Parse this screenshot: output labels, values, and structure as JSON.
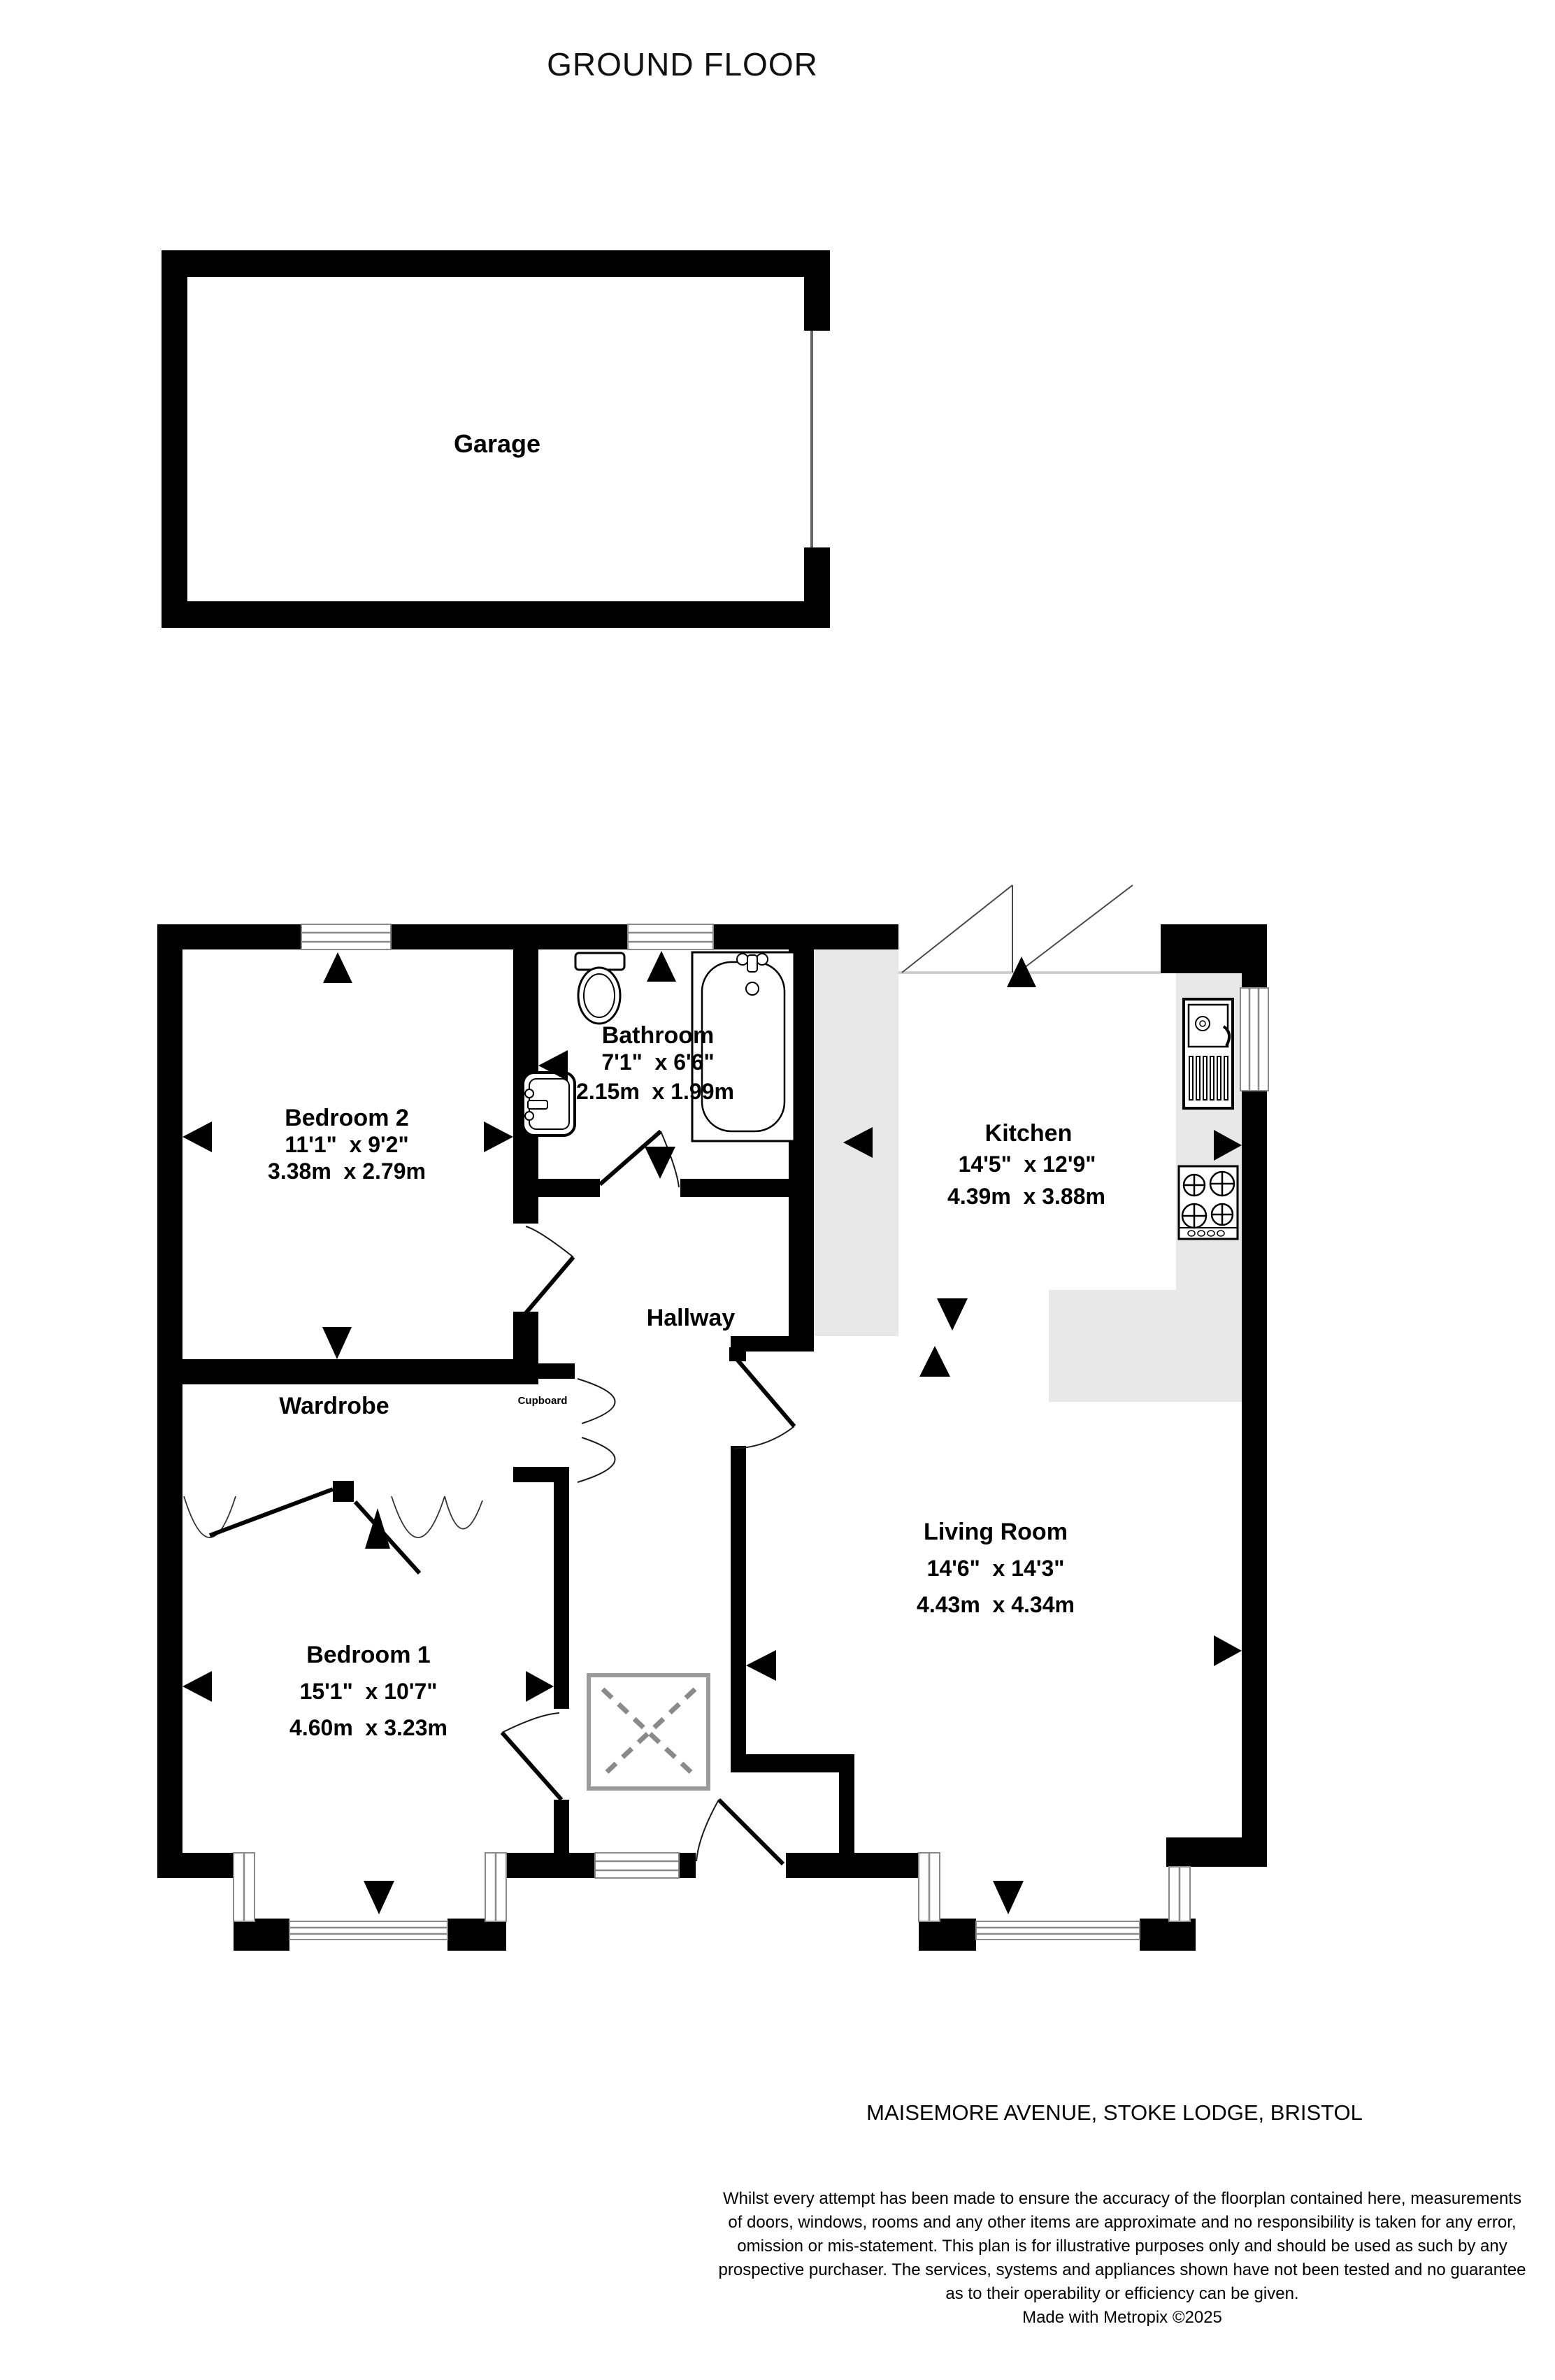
{
  "title": "GROUND FLOOR",
  "rooms": {
    "garage": {
      "name": "Garage"
    },
    "bedroom2": {
      "name": "Bedroom 2",
      "imperial": "11'1\"  x 9'2\"",
      "metric": "3.38m  x 2.79m"
    },
    "bathroom": {
      "name": "Bathroom",
      "imperial": "7'1\"  x 6'6\"",
      "metric": "2.15m  x 1.99m"
    },
    "kitchen": {
      "name": "Kitchen",
      "imperial": "14'5\"  x 12'9\"",
      "metric": "4.39m  x 3.88m"
    },
    "hallway": {
      "name": "Hallway"
    },
    "wardrobe": {
      "name": "Wardrobe"
    },
    "cupboard": {
      "name": "Cupboard"
    },
    "bedroom1": {
      "name": "Bedroom 1",
      "imperial": "15'1\"  x 10'7\"",
      "metric": "4.60m  x 3.23m"
    },
    "living_room": {
      "name": "Living Room",
      "imperial": "14'6\"  x 14'3\"",
      "metric": "4.43m  x 4.34m"
    }
  },
  "address": "MAISEMORE AVENUE, STOKE LODGE, BRISTOL",
  "disclaimer": {
    "lines": [
      "Whilst every attempt has been made to ensure the accuracy of the floorplan contained here, measurements",
      "of doors, windows, rooms and any other items are approximate and no responsibility is taken for any error,",
      "omission or mis-statement. This plan is for illustrative purposes only and should be used as such by any",
      "prospective purchaser. The services, systems and appliances shown have not been tested and no guarantee",
      "as to their operability or efficiency can be given."
    ],
    "credit": "Made with Metropix ©2025"
  },
  "icons": [
    "toilet-icon",
    "bathtub-icon",
    "basin-icon",
    "kitchen-sink-icon",
    "hob-icon",
    "skylight-icon",
    "wardrobe-rail-icon",
    "window-icon",
    "door-arc-icon",
    "measure-arrow-icon"
  ],
  "colors": {
    "wall": "#000000",
    "counter_gray": "#e8e8e8",
    "window_line": "#8a8a8a",
    "text": "#000000"
  }
}
